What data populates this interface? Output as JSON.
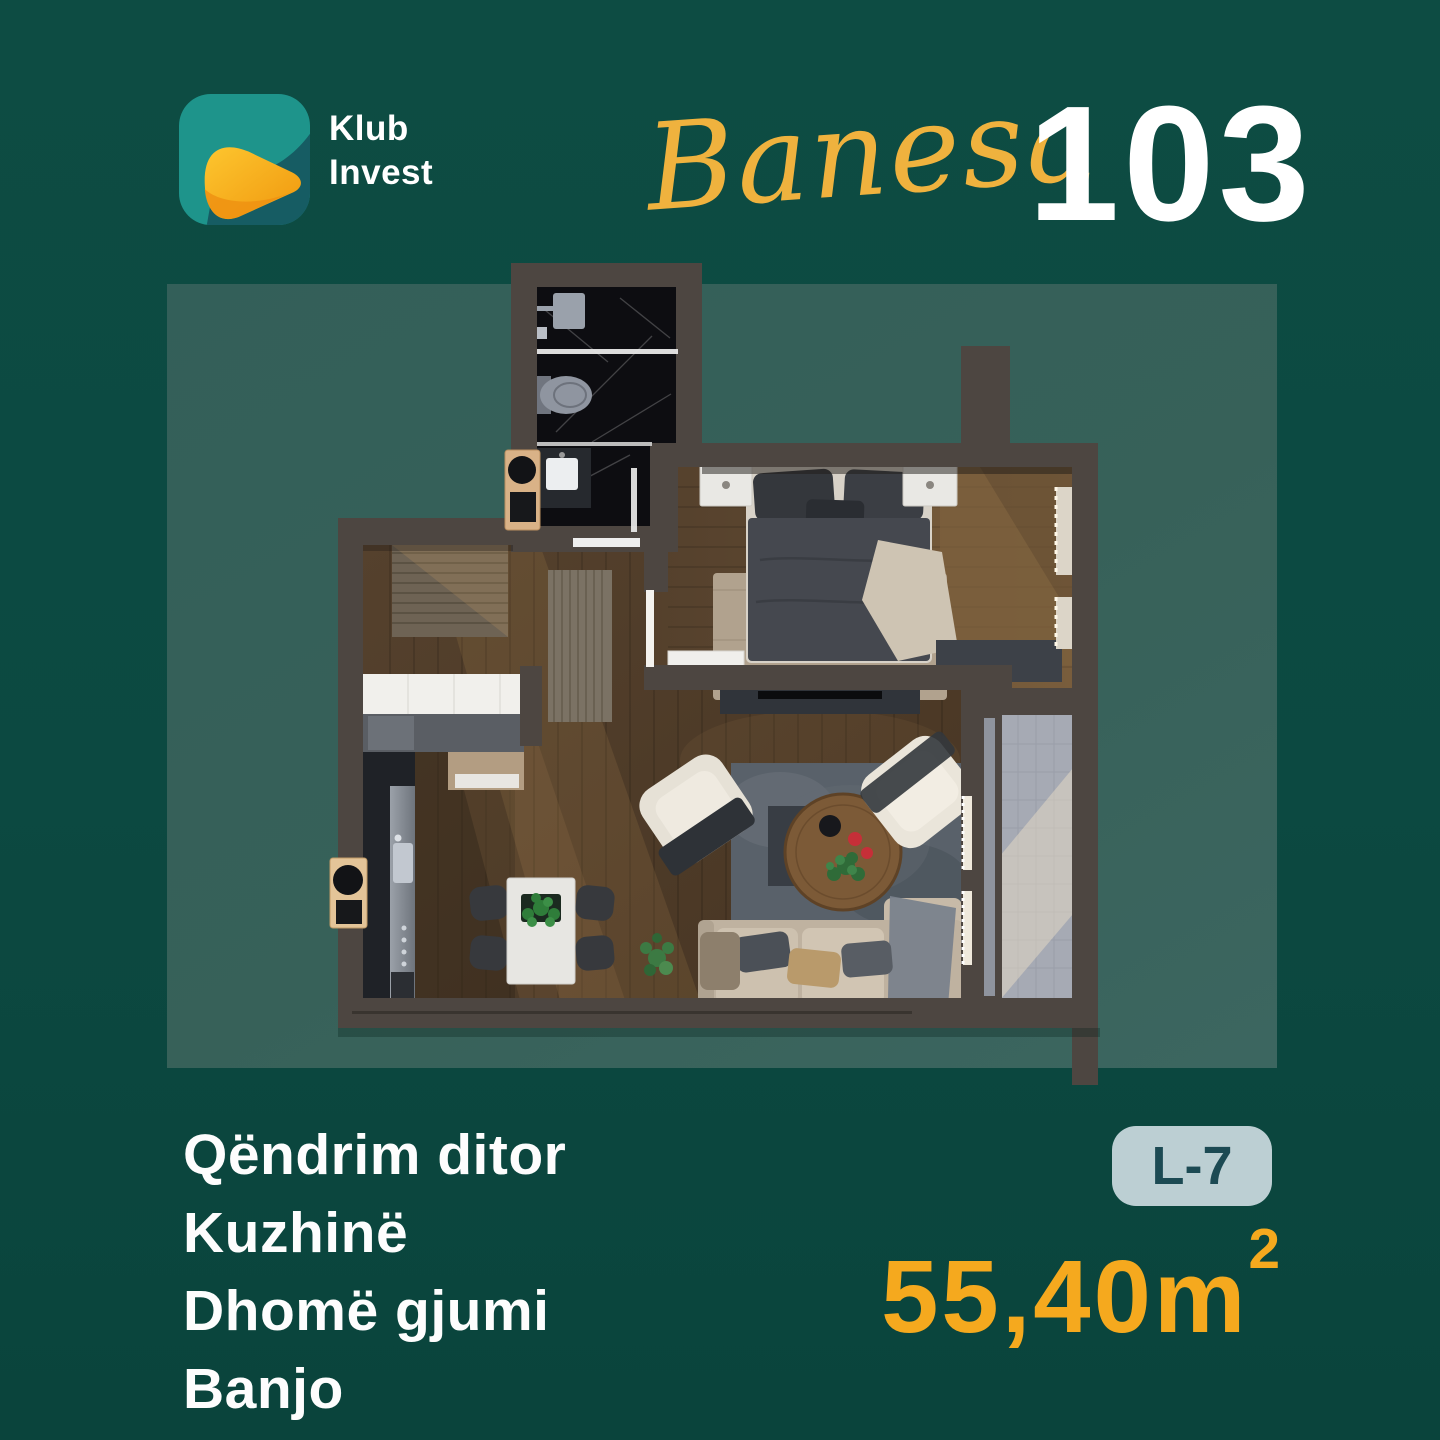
{
  "brand": {
    "line1": "Klub",
    "line2": "Invest"
  },
  "title": {
    "script": "Banesa",
    "number": "103"
  },
  "rooms": {
    "items": [
      "Qëndrim ditor",
      "Kuzhinë",
      "Dhomë gjumi",
      "Banjo"
    ]
  },
  "unit": {
    "badge": "L-7",
    "area_value": "55,40",
    "area_unit": "m",
    "area_exponent": "2"
  },
  "floor_plan": {
    "icons": [
      "bed",
      "sofa",
      "armchair",
      "coffee-table",
      "dining-table",
      "kitchen-counter",
      "toilet",
      "shower",
      "sink-vanity",
      "wardrobe",
      "tv-console",
      "balcony-tiles",
      "rug"
    ]
  },
  "colors": {
    "background": "#0C4941",
    "panel": "#35615B",
    "accent_gold": "#F5A91E",
    "title_script_gold": "#EFB23E",
    "badge_bg": "#BCCFD3",
    "badge_text": "#1C4A53",
    "text_white": "#FFFFFF",
    "wall": "#4D4641",
    "wood_floor": "#523F2C",
    "bathroom_marble": "#0D0D11",
    "balcony_tile": "#A6AAB4",
    "logo_teal": "#1E948B",
    "logo_orange": "#F5A81C"
  }
}
